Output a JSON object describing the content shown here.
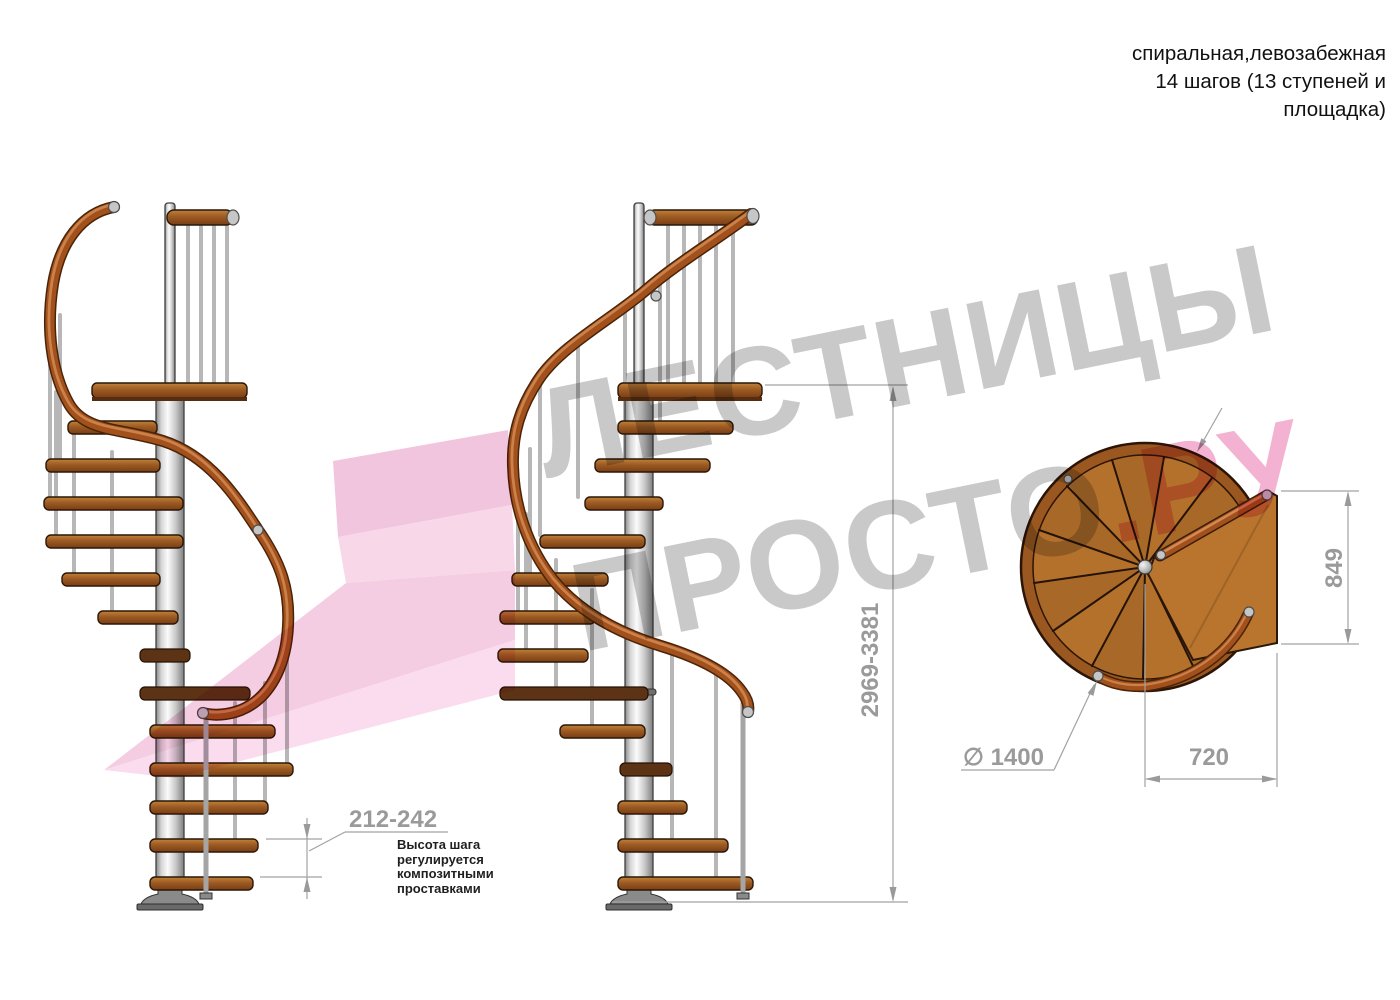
{
  "title_block": {
    "line1": "спиральная,левозабежная",
    "line2": "14 шагов (13 ступеней и",
    "line3": "площадка)"
  },
  "dimensions": {
    "height_range": "2969-3381",
    "landing_depth": "849",
    "landing_width": "720",
    "diameter": "∅ 1400",
    "step_height_range": "212-242",
    "step_height_note": "Высота шага\nрегулируется\nкомпозитными\nпроставками"
  },
  "watermark": {
    "line1": "ЛЕСТНИЦЫ",
    "line2_gray": "ПРОСТО",
    "line2_pink": ".РУ"
  },
  "colors": {
    "wood": "#9c5a23",
    "handrail": "#a3511c",
    "metal_column": "#d8d8d8",
    "dimension_gray": "#9a9a9a",
    "watermark_gray": "#c9c9c9",
    "watermark_pink": "#f3b2d1",
    "logo_pink": "#f5cde3"
  }
}
